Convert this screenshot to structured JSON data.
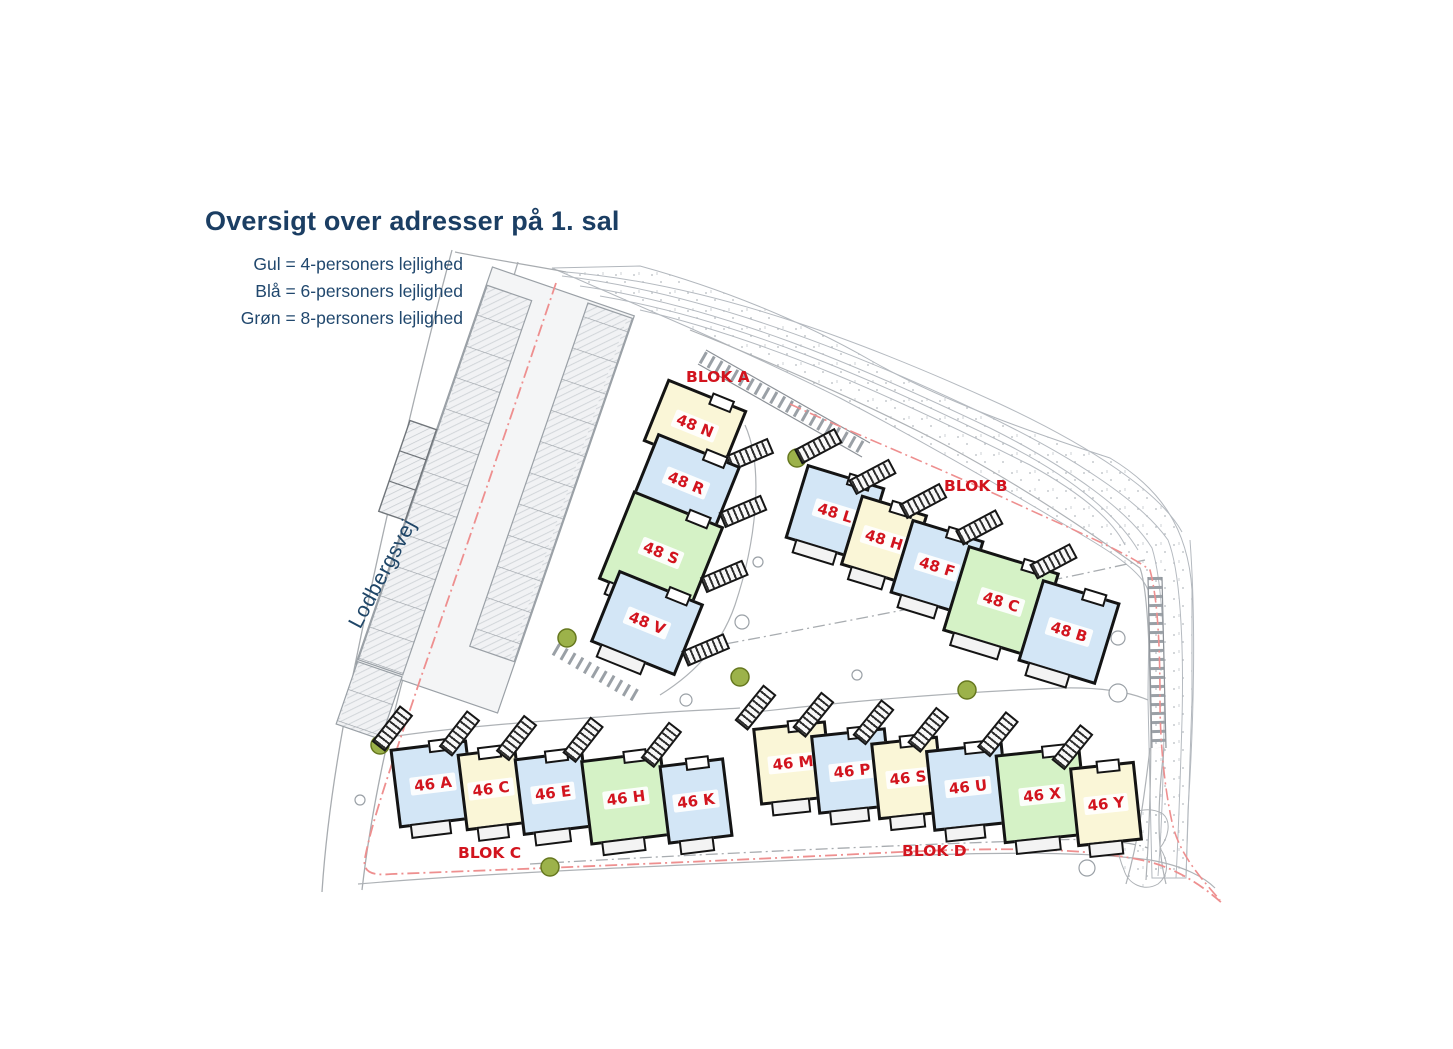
{
  "title": "Oversigt over adresser på 1. sal",
  "legend": {
    "items": [
      {
        "label": "Gul = 4-personers lejlighed",
        "color": "#faf6d7"
      },
      {
        "label": "Blå = 6-personers lejlighed",
        "color": "#d3e6f6"
      },
      {
        "label": "Grøn = 8-personers lejlighed",
        "color": "#d5f2c6"
      }
    ]
  },
  "street": {
    "name": "Lodbergsvej"
  },
  "map": {
    "colors": {
      "gul": "#faf6d7",
      "blå": "#d3e6f6",
      "grøn": "#d5f2c6",
      "label_red": "#d2141e",
      "boundary_red": "#ee8f8f",
      "text_navy": "#1b3e63"
    },
    "blocks": [
      {
        "label": "BLOK A",
        "buildings": [
          {
            "label": "48 N",
            "type": "gul"
          },
          {
            "label": "48 R",
            "type": "blå"
          },
          {
            "label": "48 S",
            "type": "grøn"
          },
          {
            "label": "48 V",
            "type": "blå"
          }
        ]
      },
      {
        "label": "BLOK B",
        "buildings": [
          {
            "label": "48 L",
            "type": "blå"
          },
          {
            "label": "48 H",
            "type": "gul"
          },
          {
            "label": "48 F",
            "type": "blå"
          },
          {
            "label": "48 C",
            "type": "grøn"
          },
          {
            "label": "48 B",
            "type": "blå"
          }
        ]
      },
      {
        "label": "BLOK C",
        "buildings": [
          {
            "label": "46 A",
            "type": "blå"
          },
          {
            "label": "46 C",
            "type": "gul"
          },
          {
            "label": "46 E",
            "type": "blå"
          },
          {
            "label": "46 H",
            "type": "grøn"
          },
          {
            "label": "46 K",
            "type": "blå"
          }
        ]
      },
      {
        "label": "BLOK D",
        "buildings": [
          {
            "label": "46 M",
            "type": "gul"
          },
          {
            "label": "46 P",
            "type": "blå"
          },
          {
            "label": "46 S",
            "type": "gul"
          },
          {
            "label": "46 U",
            "type": "blå"
          },
          {
            "label": "46 X",
            "type": "grøn"
          },
          {
            "label": "46 Y",
            "type": "gul"
          }
        ]
      }
    ]
  }
}
